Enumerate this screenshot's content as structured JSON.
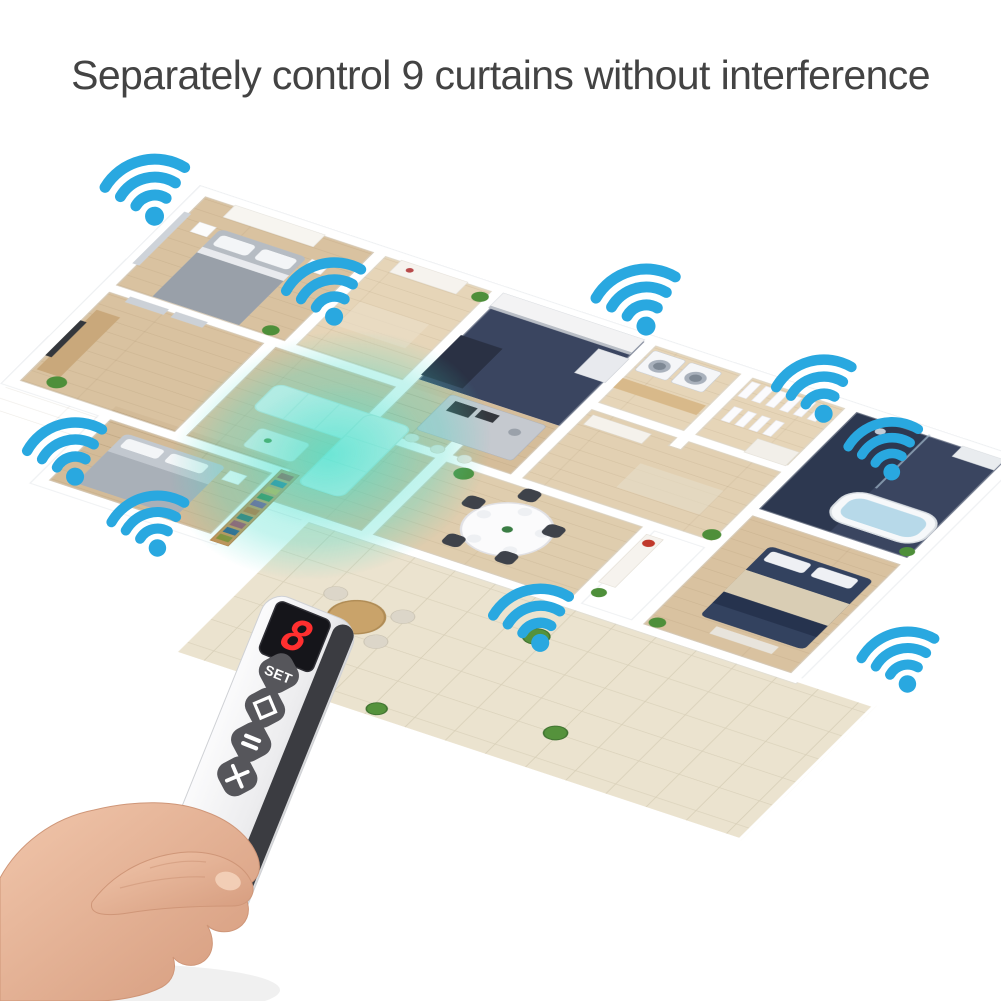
{
  "page": {
    "background_color": "#ffffff",
    "width": 1001,
    "height": 1001
  },
  "header": {
    "title": "Separately control 9 curtains without interference",
    "title_color": "#434343"
  },
  "colors": {
    "title_gray": "#434343",
    "wifi_blue": "#29a8e0",
    "glow_teal": "#40dcc8",
    "wood": "#d9c2a0",
    "wood_light": "#e6d5b8",
    "navy_tile": "#3a4560",
    "navy_dark": "#2d3850",
    "patio_tile": "#ebe3cf",
    "remote_dark": "#3b3c41",
    "button_gray": "#56565b",
    "digit_red": "#ff2f2f",
    "skin": "#eec0a5"
  },
  "floorplan": {
    "wifi_icon_color": "#29a8e0",
    "glow_color": "#40dcc8",
    "wifi_signals": [
      {
        "room": "master-bedroom",
        "x": 148,
        "y": 190,
        "size": 100,
        "rot": -14
      },
      {
        "room": "entry-hall",
        "x": 327,
        "y": 292,
        "size": 95,
        "rot": -16
      },
      {
        "room": "laundry-closet",
        "x": 639,
        "y": 300,
        "size": 100,
        "rot": -15
      },
      {
        "room": "bathroom-window",
        "x": 817,
        "y": 389,
        "size": 95,
        "rot": -15
      },
      {
        "room": "right-wall",
        "x": 886,
        "y": 449,
        "size": 88,
        "rot": -14
      },
      {
        "room": "tv-room",
        "x": 68,
        "y": 452,
        "size": 95,
        "rot": -16
      },
      {
        "room": "second-bedroom",
        "x": 151,
        "y": 524,
        "size": 92,
        "rot": -15
      },
      {
        "room": "dining-room",
        "x": 534,
        "y": 618,
        "size": 95,
        "rot": -14
      },
      {
        "room": "right-bedroom",
        "x": 901,
        "y": 660,
        "size": 92,
        "rot": -15
      }
    ]
  },
  "remote": {
    "display_value": "8",
    "display_color": "#ff2f2f",
    "buttons": [
      {
        "name": "set-button",
        "label": "SET"
      },
      {
        "name": "diamond-button",
        "icon": "diamond-icon"
      },
      {
        "name": "pause-button",
        "icon": "pause-icon"
      },
      {
        "name": "close-button",
        "icon": "x-icon"
      }
    ]
  }
}
